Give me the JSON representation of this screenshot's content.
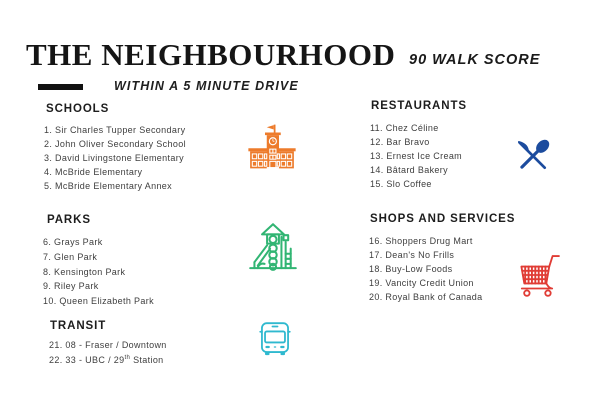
{
  "page": {
    "title": "THE NEIGHBOURHOOD",
    "subtitle": "WITHIN A 5 MINUTE DRIVE",
    "walk_score": "90 WALK SCORE"
  },
  "sections": {
    "schools": {
      "header": "SCHOOLS",
      "items": [
        "1. Sir Charles Tupper Secondary",
        "2. John Oliver Secondary School",
        "3. David Livingstone Elementary",
        "4. McBride Elementary",
        "5. McBride Elementary Annex"
      ]
    },
    "parks": {
      "header": "PARKS",
      "items": [
        "6. Grays Park",
        "7. Glen Park",
        "8. Kensington Park",
        "9. Riley Park",
        "10. Queen Elizabeth Park"
      ]
    },
    "transit": {
      "header": "TRANSIT",
      "item_21": "21. 08 - Fraser / Downtown",
      "item_22_pre": "22. 33 - UBC / 29",
      "item_22_sup": "th",
      "item_22_post": " Station"
    },
    "restaurants": {
      "header": "RESTAURANTS",
      "items": [
        "11. Chez Céline",
        "12. Bar Bravo",
        "13. Ernest Ice Cream",
        "14. Bâtard Bakery",
        "15. Slo Coffee"
      ]
    },
    "shops": {
      "header": "SHOPS AND SERVICES",
      "items": [
        "16. Shoppers Drug Mart",
        "17. Dean's No Frills",
        "18. Buy-Low Foods",
        "19. Vancity Credit Union",
        "20. Royal Bank of Canada"
      ]
    }
  },
  "icons": {
    "school": {
      "name": "school-building-icon",
      "color": "#ED7B2B"
    },
    "playground": {
      "name": "playground-icon",
      "color": "#31B573"
    },
    "bus": {
      "name": "bus-icon",
      "color": "#2FB9CF"
    },
    "cutlery": {
      "name": "cutlery-icon",
      "color": "#1C4C9E"
    },
    "cart": {
      "name": "shopping-cart-icon",
      "color": "#E03C35"
    }
  },
  "colors": {
    "accent_bar": "#111111",
    "title_text": "#151515",
    "list_text": "#3E3E3E"
  }
}
